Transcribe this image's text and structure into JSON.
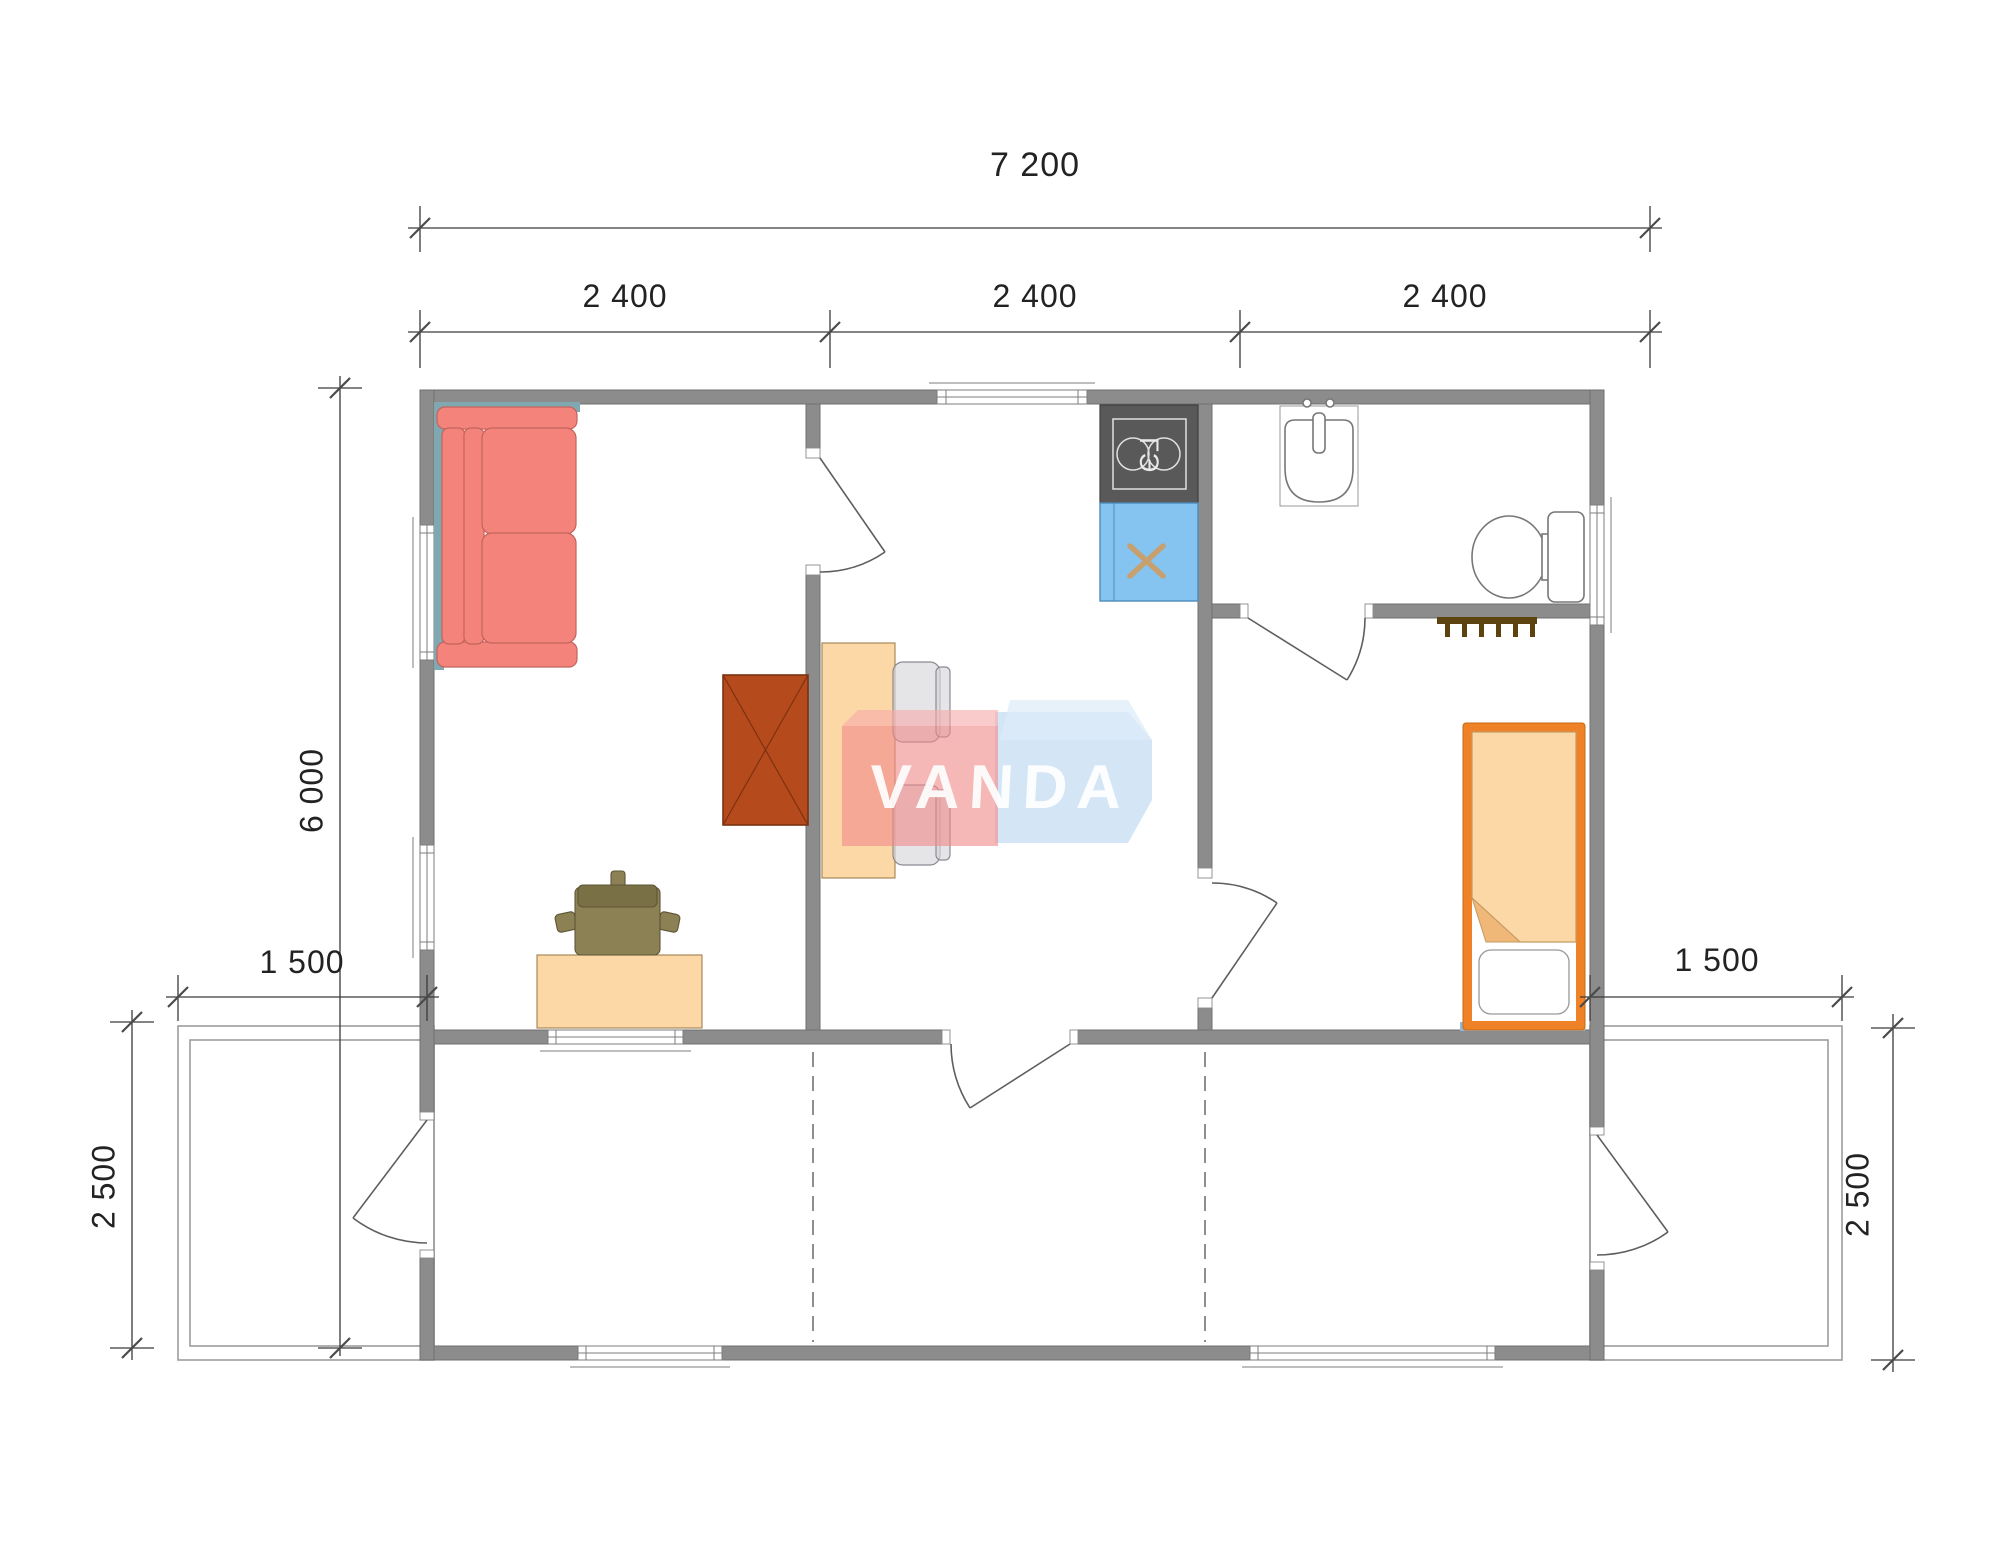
{
  "watermark": {
    "brand": "VANDA"
  },
  "dimensions": {
    "overall_width": "7 200",
    "modules": [
      "2 400",
      "2 400",
      "2 400"
    ],
    "overall_depth": "6 000",
    "left_terrace_width": "1 500",
    "right_terrace_width": "1 500",
    "left_terrace_depth": "2 500",
    "right_terrace_depth": "2 500"
  },
  "appliances": {
    "stove_label": "ГЭ"
  },
  "colors": {
    "wall": "#8C8C8C",
    "sofa": "#F4837B",
    "wardrobe": "#B54A1C",
    "desk": "#FBD8A6",
    "office_chair": "#8C8155",
    "stove": "#595959",
    "kitchen_sink": "#85C3F0",
    "sink_cross": "#C8A06E",
    "dining_table": "#FBD8A6",
    "dining_chair": "#D7D7DC",
    "bed_frame": "#EF8226",
    "bed_blanket": "#FBD8A6",
    "coat_hooks": "#5C430F",
    "furniture_shadow": "#7FA8B0",
    "watermark_red": "#F18A8A",
    "watermark_blue": "#C3DDF2",
    "dimension_text": "#222222"
  }
}
